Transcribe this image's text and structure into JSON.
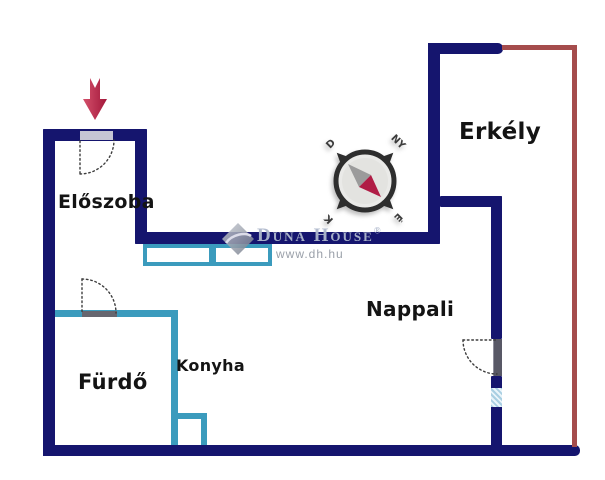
{
  "floorplan": {
    "rooms": {
      "eloszoba": "Előszoba",
      "erkely": "Erkély",
      "nappali": "Nappali",
      "konyha": "Konyha",
      "furdo": "Fürdő"
    },
    "compass": {
      "d": "D",
      "ny": "NY",
      "k": "K",
      "e": "É"
    },
    "watermark": {
      "brand": "Duna House",
      "reg": "®",
      "url": "www.dh.hu"
    },
    "colors": {
      "wall": "#15156e",
      "partition": "#3b9bbd",
      "railing": "#a54c4c",
      "ring": "#2e2e2e",
      "needle": "#b01c45",
      "needle-gray": "#9b9b9b",
      "arrow-light": "#d4506b",
      "arrow-dark": "#a3173a",
      "label": "#141414"
    }
  }
}
